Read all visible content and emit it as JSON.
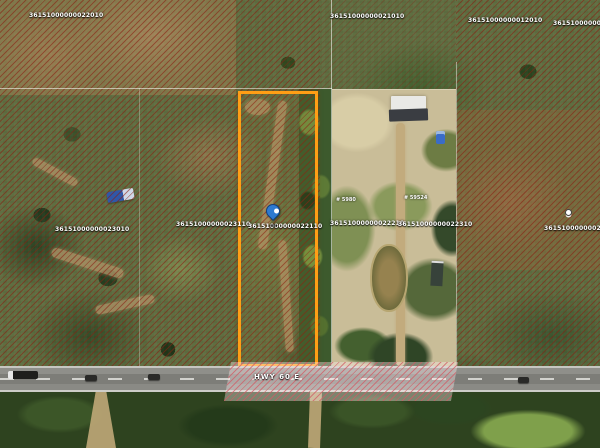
{
  "road_label": "HWY 60 E",
  "parcel_labels": [
    "36151000000022010",
    "36151000000021010",
    "36151000000012010",
    "36151000000011010",
    "36151000000023010",
    "36151000000023110",
    "36151000000022110",
    "36151000000022210",
    "36151000000022310",
    "36151000000021310"
  ],
  "site_labels": [
    "# 59524",
    "# 5980"
  ],
  "selected_parcel": {
    "outline_color": "#ff9e15",
    "parcel_id": "36151000000022110"
  },
  "markers": {
    "pin_color": "#2e7ad0"
  },
  "colors": {
    "hatch": "#8a1f12",
    "road_hatch": "#d25a64",
    "road": "#8a8a85",
    "sand": "#c9bd98"
  }
}
